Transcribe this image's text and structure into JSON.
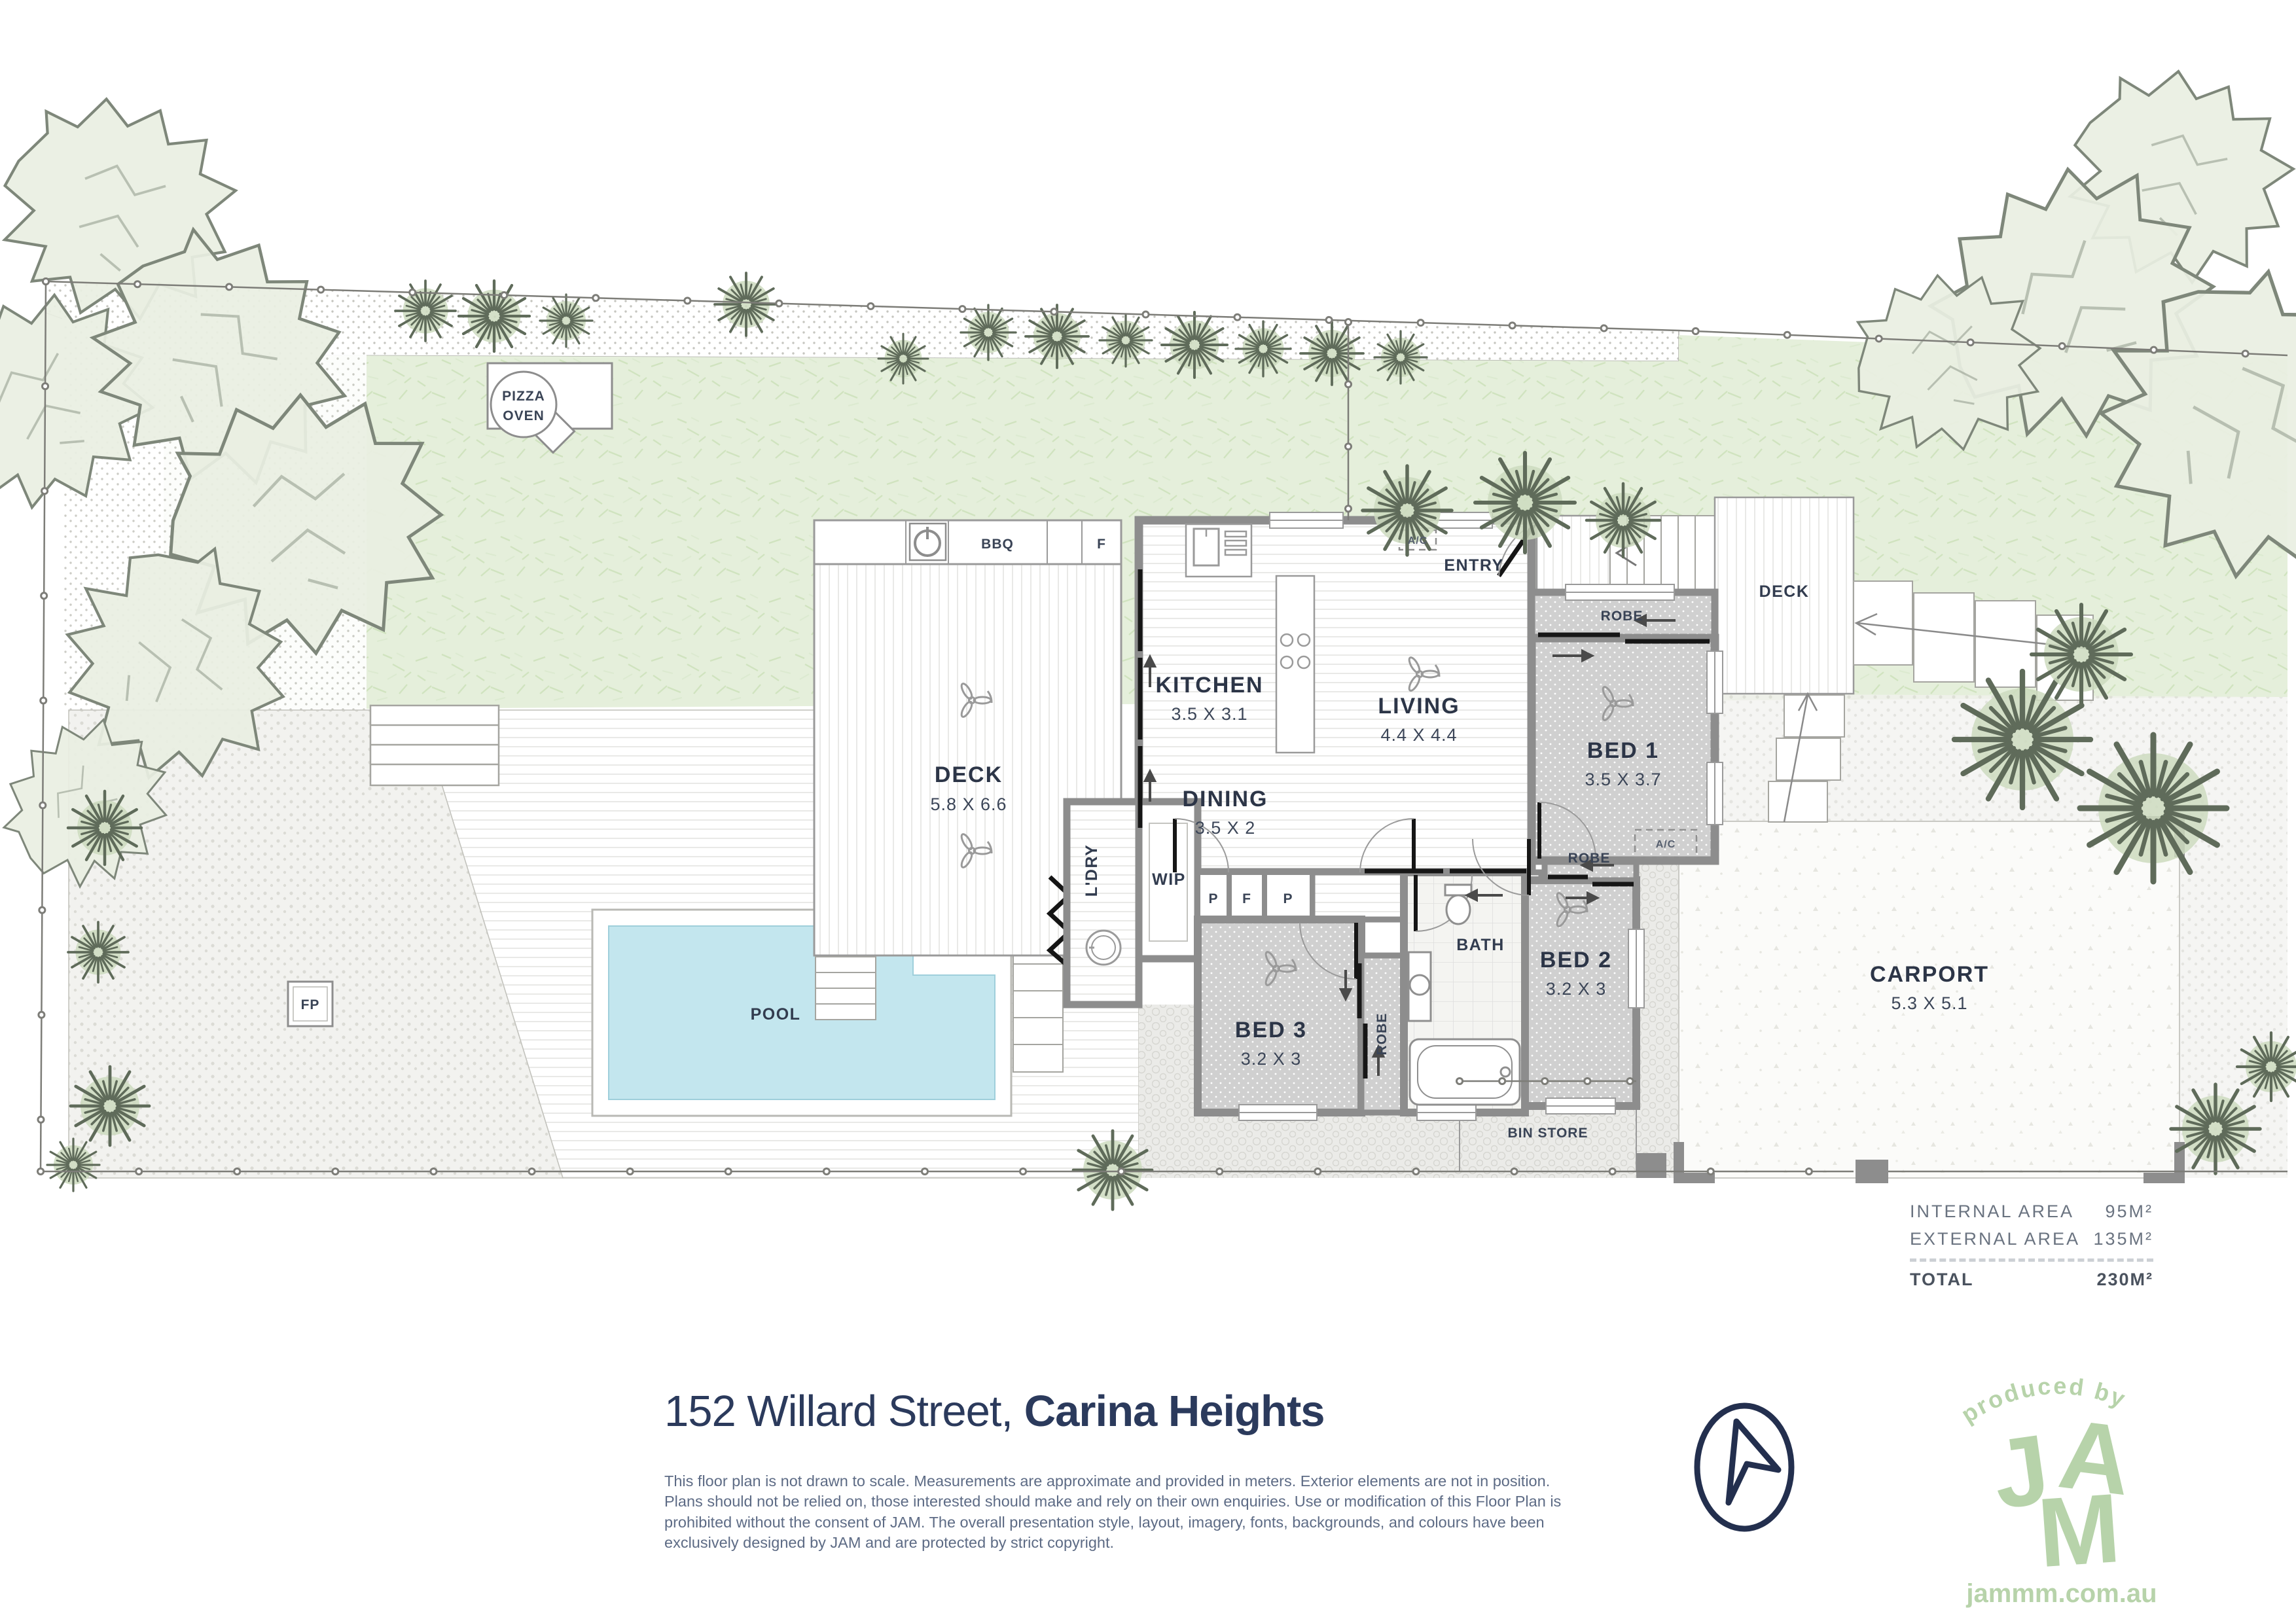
{
  "plan": {
    "rooms": {
      "deck_main": {
        "name": "DECK",
        "dims": "5.8 X 6.6"
      },
      "kitchen": {
        "name": "KITCHEN",
        "dims": "3.5 X 3.1"
      },
      "dining": {
        "name": "DINING",
        "dims": "3.5 X 2"
      },
      "living": {
        "name": "LIVING",
        "dims": "4.4 X 4.4"
      },
      "bed1": {
        "name": "BED 1",
        "dims": "3.5 X 3.7"
      },
      "bed2": {
        "name": "BED 2",
        "dims": "3.2 X 3"
      },
      "bed3": {
        "name": "BED 3",
        "dims": "3.2 X 3"
      },
      "carport": {
        "name": "CARPORT",
        "dims": "5.3 X 5.1"
      },
      "bath": {
        "name": "BATH"
      },
      "entry": {
        "name": "ENTRY"
      },
      "wip": {
        "name": "WIP"
      },
      "ldry": {
        "name": "L'DRY"
      },
      "pool": {
        "name": "POOL"
      },
      "deck_right": {
        "name": "DECK"
      },
      "bin_store": {
        "name": "BIN STORE"
      }
    },
    "labels": {
      "pizza_line1": "PIZZA",
      "pizza_line2": "OVEN",
      "bbq": "BBQ",
      "fridge": "F",
      "pantry": "P",
      "robe": "ROBE",
      "ac": "A/C",
      "fp": "FP"
    },
    "areas": {
      "internal_label": "INTERNAL AREA",
      "internal_value": "95M²",
      "external_label": "EXTERNAL AREA",
      "external_value": "135M²",
      "total_label": "TOTAL",
      "total_value": "230M²"
    }
  },
  "title": {
    "street": "152 Willard Street, ",
    "suburb": "Carina Heights"
  },
  "disclaimer": "This floor plan is not drawn to scale. Measurements are approximate and provided in meters. Exterior elements are not in position. Plans should not be relied on, those interested should make and rely on their own enquiries. Use or modification of this Floor Plan is prohibited without the consent of JAM. The overall presentation style, layout, imagery, fonts, backgrounds, and colours have been exclusively designed by JAM and are protected by strict copyright.",
  "logo": {
    "produced_by": "produced by",
    "letter_j": "J",
    "letter_a": "A",
    "letter_m": "M",
    "url": "jammm.com.au"
  }
}
